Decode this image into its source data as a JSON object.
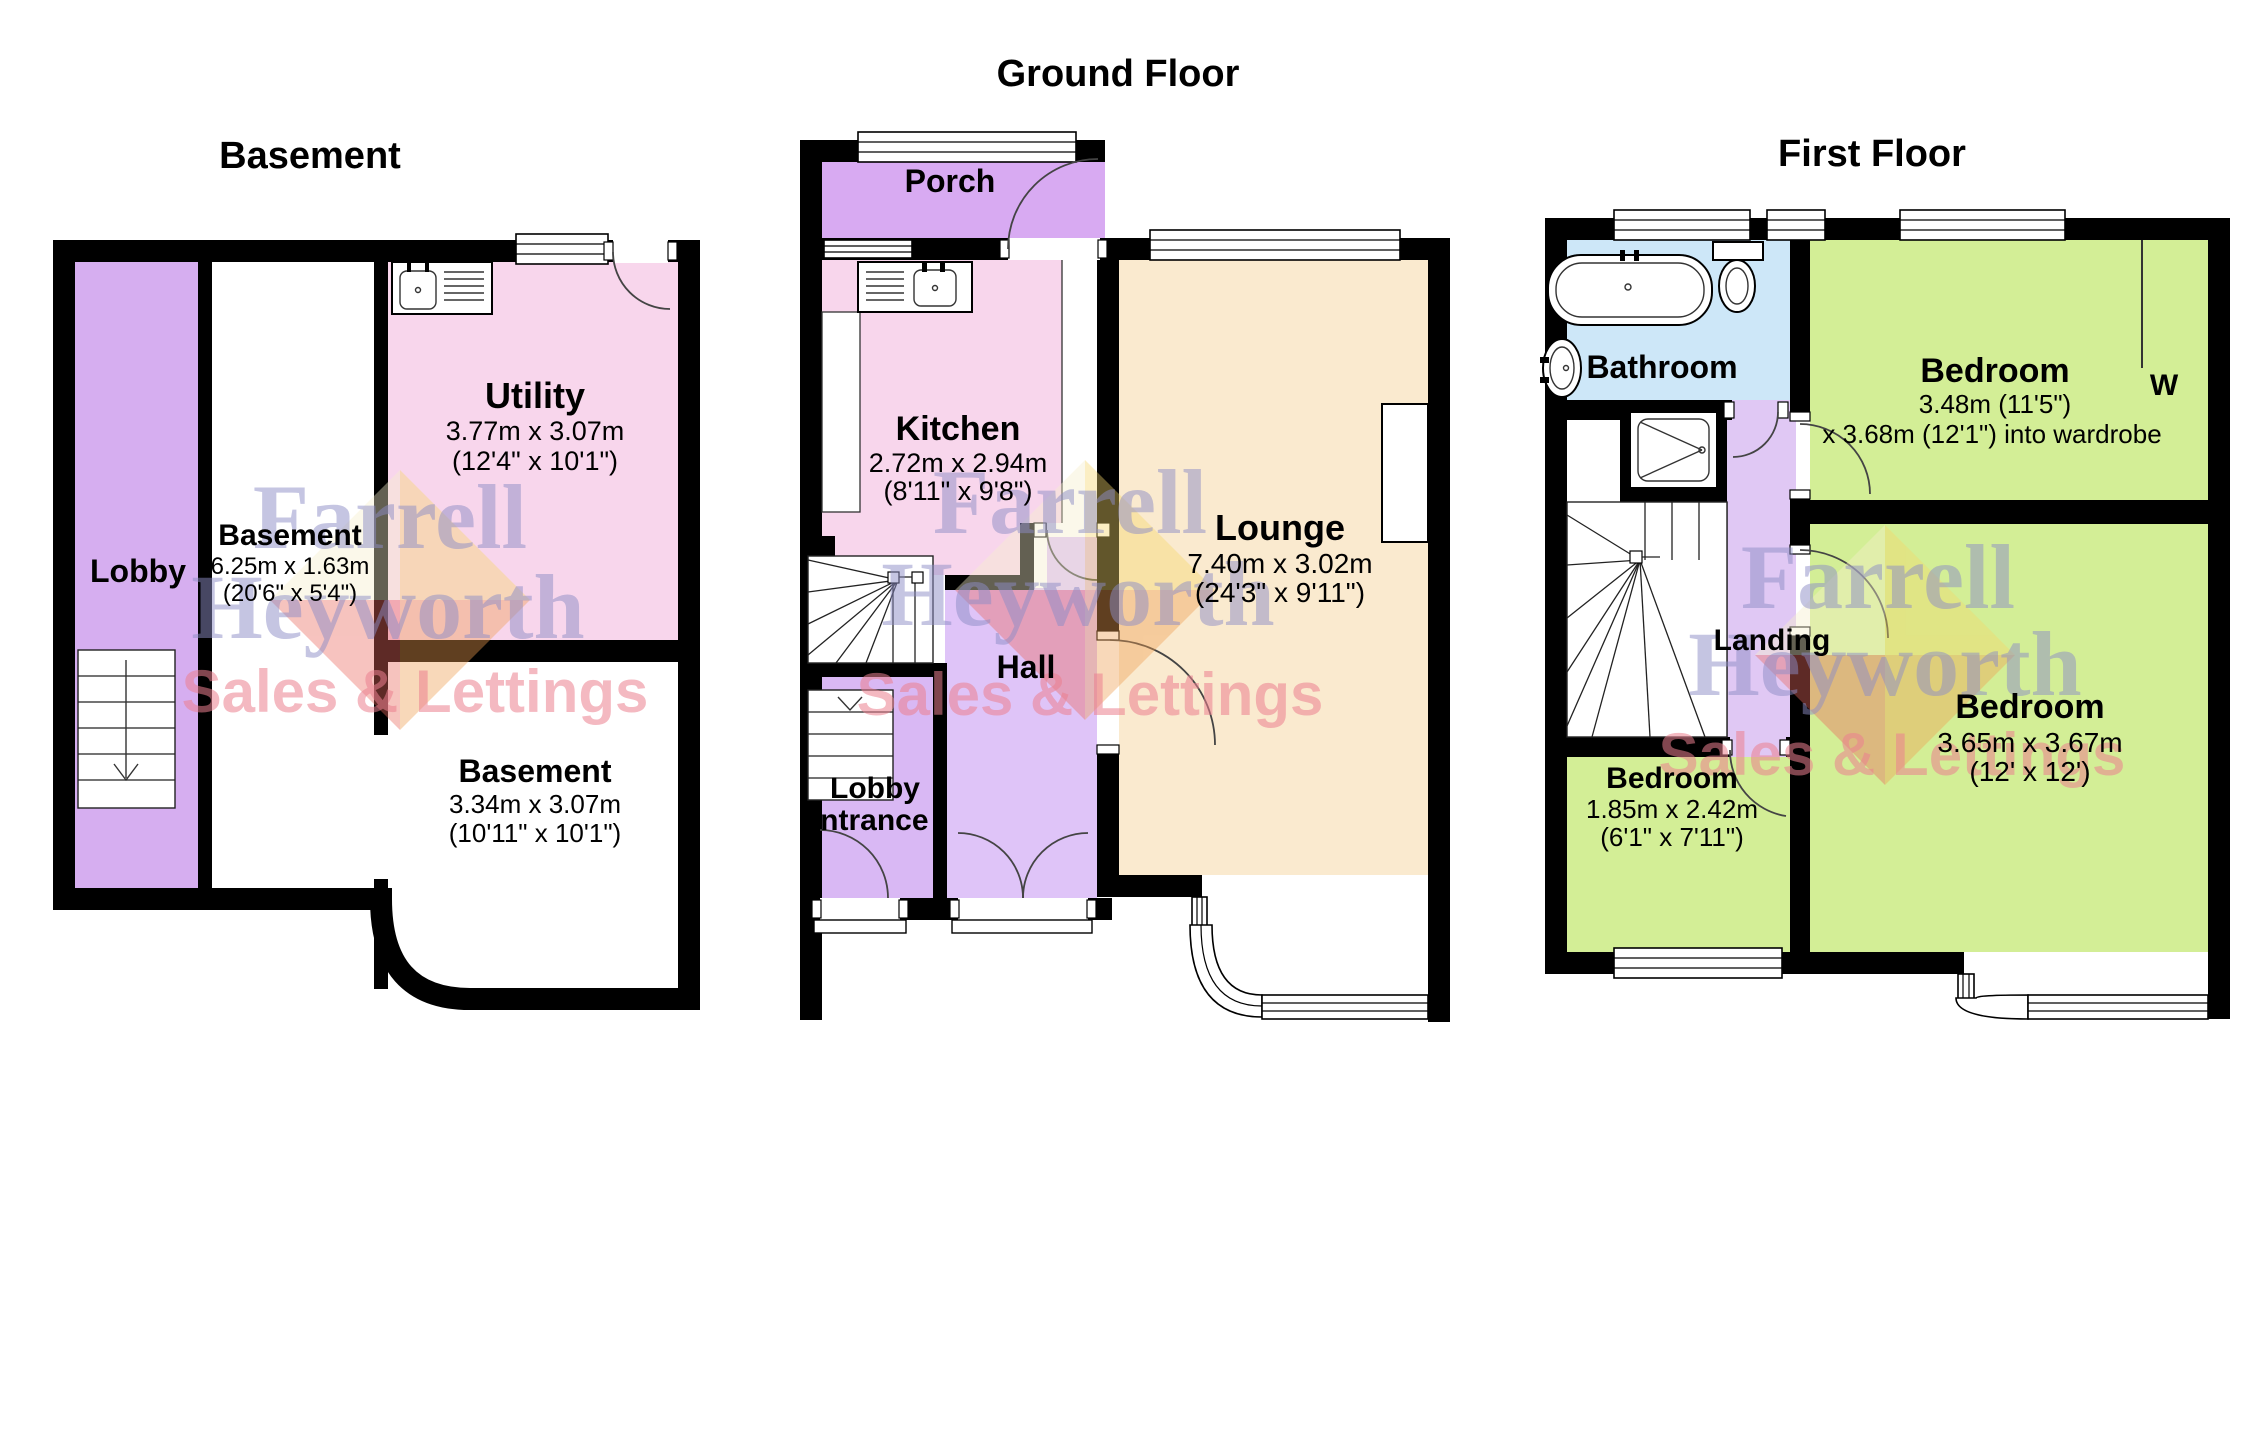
{
  "watermark": {
    "line1": "Farrell",
    "line2": "Heyworth",
    "line3": "Sales & Lettings"
  },
  "colors": {
    "wall": "#000000",
    "lobby": "#d6aef0",
    "porch": "#d8aaf2",
    "hall": "#dfc4f8",
    "lobby_entrance": "#d9b8f4",
    "landing": "#e0c8f4",
    "kitchen_pink": "#f8d6ec",
    "lounge_cream": "#faeacf",
    "bedroom_green": "#d3ee96",
    "bathroom_blue": "#cde7f8",
    "watermark_blue": "#8d8dc6",
    "watermark_pink": "#ec8090"
  },
  "floors": {
    "basement": {
      "title": "Basement",
      "rooms": {
        "lobby": {
          "name": "Lobby"
        },
        "basement_mid": {
          "name": "Basement",
          "dims_m": "6.25m x 1.63m",
          "dims_ft": "(20'6\" x 5'4\")"
        },
        "utility": {
          "name": "Utility",
          "dims_m": "3.77m x 3.07m",
          "dims_ft": "(12'4\" x 10'1\")"
        },
        "basement_lower": {
          "name": "Basement",
          "dims_m": "3.34m x 3.07m",
          "dims_ft": "(10'11\" x 10'1\")"
        }
      }
    },
    "ground": {
      "title": "Ground Floor",
      "rooms": {
        "porch": {
          "name": "Porch"
        },
        "kitchen": {
          "name": "Kitchen",
          "dims_m": "2.72m x 2.94m",
          "dims_ft": "(8'11\" x 9'8\")"
        },
        "hall": {
          "name": "Hall"
        },
        "lobby_entrance": {
          "name_line1": "Lobby",
          "name_line2": "entrance"
        },
        "lounge": {
          "name": "Lounge",
          "dims_m": "7.40m x 3.02m",
          "dims_ft": "(24'3\" x 9'11\")"
        }
      }
    },
    "first": {
      "title": "First Floor",
      "rooms": {
        "bathroom": {
          "name": "Bathroom"
        },
        "landing": {
          "name": "Landing"
        },
        "bedroom1": {
          "name": "Bedroom",
          "dims_line1": "3.48m (11'5\")",
          "dims_line2": "x 3.68m (12'1\") into wardrobe"
        },
        "wardrobe": {
          "label": "W"
        },
        "bedroom2": {
          "name": "Bedroom",
          "dims_m": "3.65m x 3.67m",
          "dims_ft": "(12' x 12')"
        },
        "bedroom3": {
          "name": "Bedroom",
          "dims_m": "1.85m x 2.42m",
          "dims_ft": "(6'1\" x 7'11\")"
        }
      }
    }
  }
}
